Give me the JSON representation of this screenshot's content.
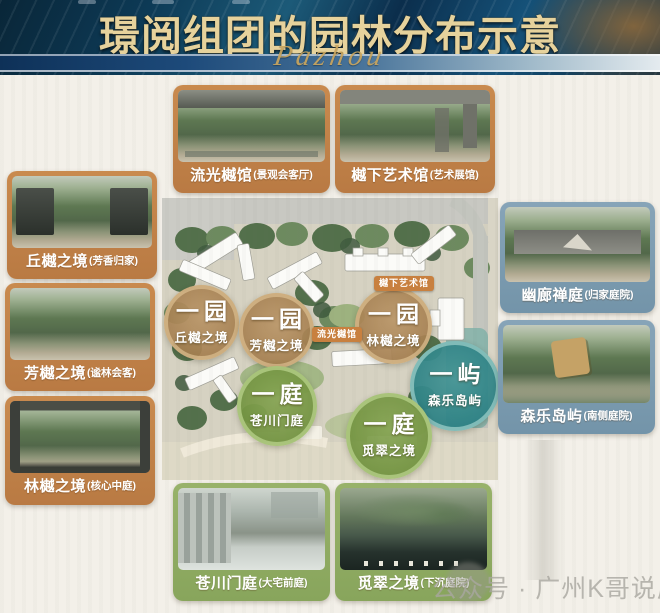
{
  "header": {
    "title": "璟阅组团的园林分布示意",
    "script": "Pazhou"
  },
  "map": {
    "tags": [
      {
        "label": "樾下艺术馆"
      },
      {
        "label": "流光樾馆"
      }
    ],
    "zones": [
      {
        "badge": "一园",
        "name": "丘樾之境",
        "color_key": "tan"
      },
      {
        "badge": "一园",
        "name": "芳樾之境",
        "color_key": "tan"
      },
      {
        "badge": "一园",
        "name": "林樾之境",
        "color_key": "tan"
      },
      {
        "badge": "一屿",
        "name": "森乐岛屿",
        "color_key": "teal"
      },
      {
        "badge": "一庭",
        "name": "苍川门庭",
        "color_key": "green"
      },
      {
        "badge": "一庭",
        "name": "觅翠之境",
        "color_key": "green"
      }
    ]
  },
  "cards": {
    "top1": {
      "name": "流光樾馆",
      "note": "(景观会客厅)"
    },
    "top2": {
      "name": "樾下艺术馆",
      "note": "(艺术展馆)"
    },
    "left1": {
      "name": "丘樾之境",
      "note": "(芳香归家)"
    },
    "left2": {
      "name": "芳樾之境",
      "note": "(谧林会客)"
    },
    "left3": {
      "name": "林樾之境",
      "note": "(核心中庭)"
    },
    "right1": {
      "name": "幽廊禅庭",
      "note": "(归家庭院)"
    },
    "right2": {
      "name": "森乐岛屿",
      "note": "(南侧庭院)"
    },
    "bottom1": {
      "name": "苍川门庭",
      "note": "(大宅前庭)"
    },
    "bottom2": {
      "name": "觅翠之境",
      "note": "(下沉庭院)"
    }
  },
  "watermark": "公众号 · 广州K哥说房",
  "colors": {
    "title_gold": "#e6d29c",
    "header_navy": "#0d3a56",
    "card_orange": "#c08148",
    "card_blue": "#7e9cb0",
    "card_green": "#90ab63",
    "zone_tan": "#b2885a",
    "zone_green": "#7ba24f",
    "zone_teal": "#2f8b8f",
    "tag_orange": "#c8803f"
  }
}
